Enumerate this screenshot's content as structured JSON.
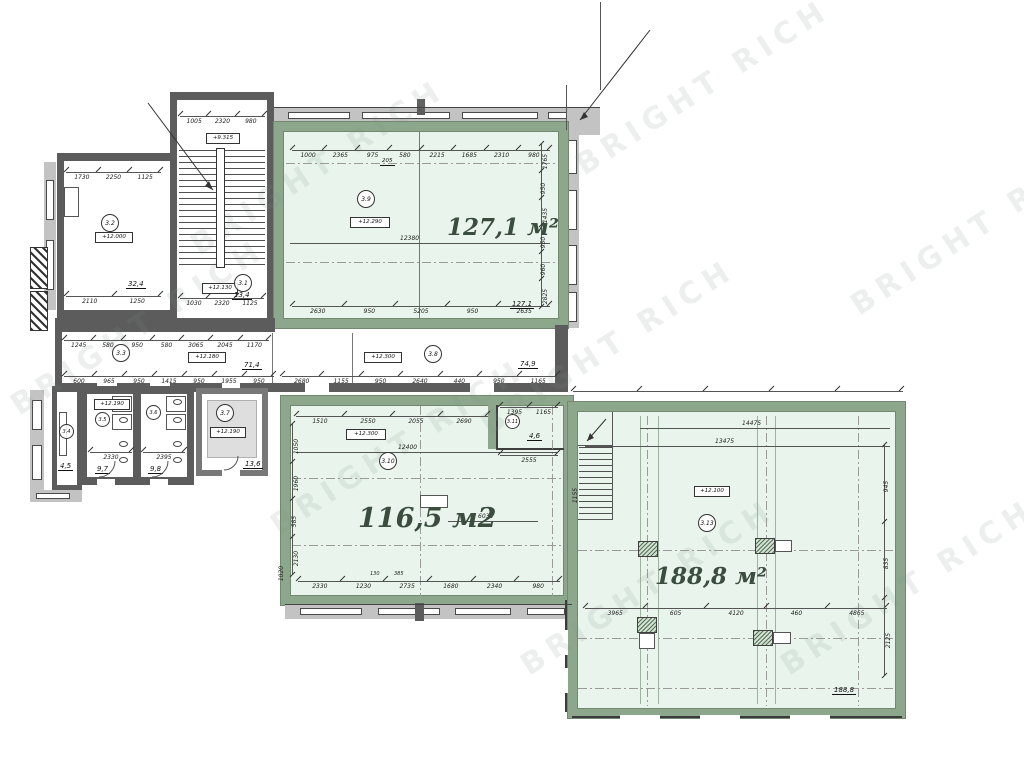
{
  "watermark": {
    "text": "BRIGHT RICH"
  },
  "rooms": {
    "r31": {
      "number": "3.1",
      "level_mid": "+9.315",
      "level": "+12.130",
      "area": "13,4"
    },
    "r32": {
      "number": "3.2",
      "level": "+12.000",
      "area": "32,4"
    },
    "r33": {
      "number": "3.3",
      "level": "+12.180",
      "area": "71,4"
    },
    "r34": {
      "number": "3.4",
      "area": "4,5"
    },
    "r35": {
      "number": "3.5",
      "level": "+12.190",
      "area": "9,7"
    },
    "r36": {
      "number": "3.6",
      "area": "9,8"
    },
    "r37": {
      "number": "3.7",
      "level": "+12.190",
      "area": "13,6"
    },
    "r38": {
      "number": "3.8",
      "level": "+12.300",
      "area": "74,9"
    },
    "r39": {
      "number": "3.9",
      "level": "+12.290",
      "area_label": "127,1 м²",
      "area_small": "127,1"
    },
    "r310": {
      "number": "3.10",
      "level": "+12.300",
      "area_label": "116,5 м2"
    },
    "r311": {
      "number": "3.11",
      "area": "4,6"
    },
    "r313": {
      "number": "3.13",
      "level": "+12.100",
      "area_label": "188,8 м²",
      "area_small": "188,8"
    }
  },
  "dims": {
    "stair_top": [
      "1005",
      "2320",
      "980"
    ],
    "stair_bottom": [
      "1030",
      "2320",
      "1125"
    ],
    "r32_top": [
      "1730",
      "2250",
      "1125"
    ],
    "r32_bottom": [
      "2110",
      "1250"
    ],
    "r39_top": [
      "1000",
      "2365",
      "975",
      "580",
      "2215",
      "1685",
      "2310",
      "980"
    ],
    "r39_top_sub": "205",
    "r39_bottom": [
      "2630",
      "950",
      "5205",
      "950",
      "2635"
    ],
    "r39_mid": "12380",
    "r39_right": [
      "1765",
      "950",
      "1435",
      "950",
      "960",
      "2825"
    ],
    "corr_top": [
      "1245",
      "580",
      "950",
      "580",
      "3065",
      "2045",
      "1170"
    ],
    "corr_bottom_left": [
      "600",
      "965",
      "950",
      "1415",
      "950",
      "1955",
      "950"
    ],
    "corr_bottom_right": [
      "2680",
      "1155",
      "950",
      "2640",
      "440",
      "950",
      "1165"
    ],
    "r35_w": [
      "2330"
    ],
    "r36_w": [
      "2395"
    ],
    "r310_top": [
      "1510",
      "2550",
      "2055",
      "2690"
    ],
    "r310_mid": "12400",
    "r310_bottom": [
      "2330",
      "1230",
      "2735",
      "1680",
      "2340",
      "980"
    ],
    "r310_bottom_sub_a": "130",
    "r310_bottom_sub_b": "385",
    "r310_left": [
      "1050",
      "1960",
      "585",
      "2130"
    ],
    "r310_left_edge": "1020",
    "r310_right": "6035",
    "r311_top": [
      "1395",
      "1165"
    ],
    "r311_w": [
      "2555"
    ],
    "r313_bottom": [
      "3965",
      "605",
      "4120",
      "460",
      "4865"
    ],
    "r313_right": [
      "945",
      "835",
      "2125"
    ],
    "r313_line1": "14475",
    "r313_line2": "13475",
    "r313_stair": "1155"
  }
}
